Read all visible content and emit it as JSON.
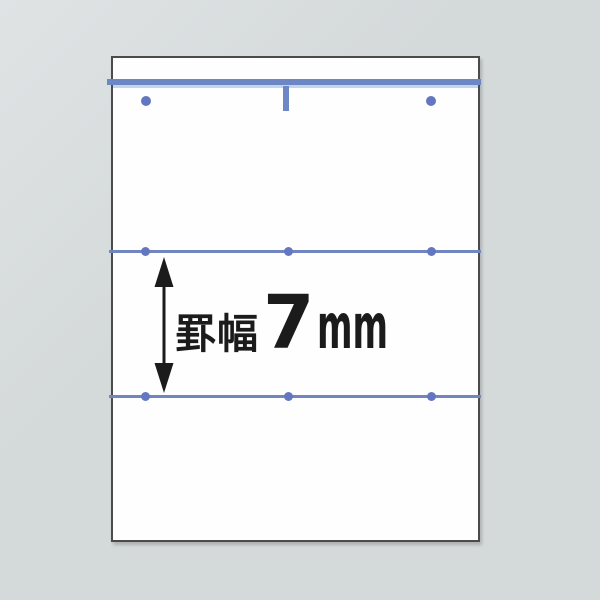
{
  "diagram": {
    "measurement_label": {
      "prefix": "罫幅",
      "value": "7",
      "unit": "mm",
      "full_text": "罫幅7mm"
    },
    "rule_width_mm": 7,
    "colors": {
      "background": "#d4d9da",
      "background-light": "#dfe3e4",
      "paper": "#fefefe",
      "paper-border": "#4b4b4b",
      "header-rule": "#6d87c5",
      "header-rule-light": "#bed7ed",
      "rule-line": "#7285bf",
      "dot": "#6377c0",
      "annotation": "#1b1b1b",
      "arrow": "#1b1b1b"
    }
  }
}
